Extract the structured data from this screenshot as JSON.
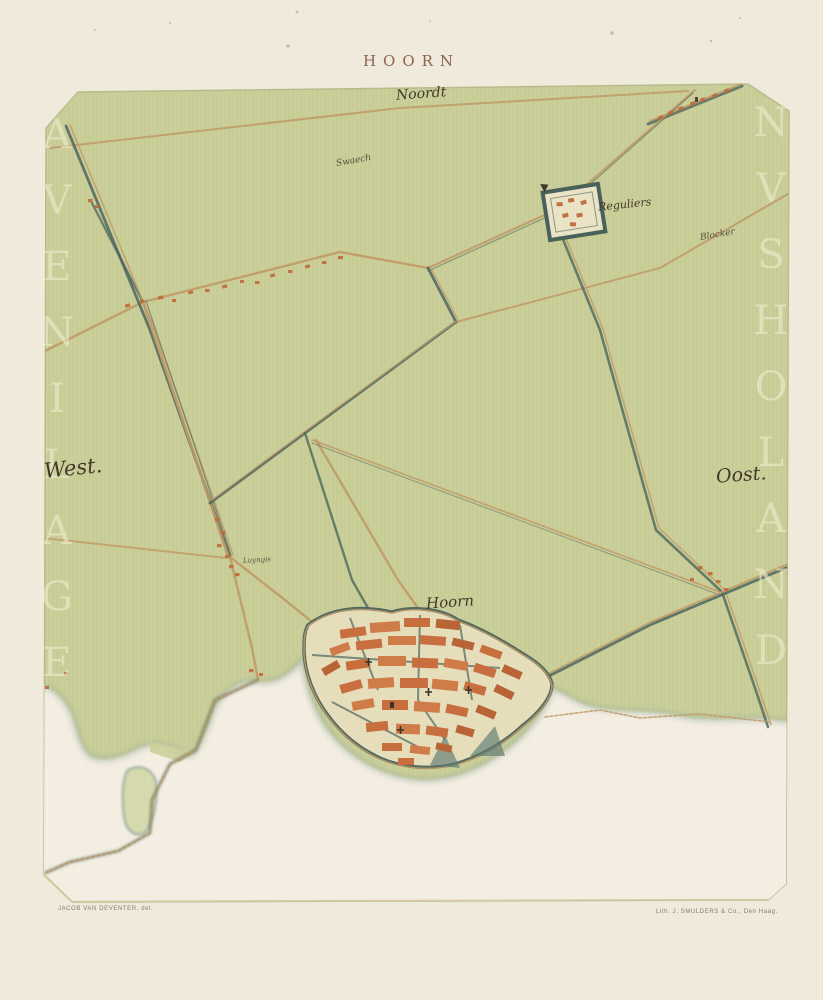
{
  "page": {
    "title": "HOORN",
    "imprint_left": "JACOB VAN DEVENTER, del.",
    "imprint_right": "Lith. J. SMULDERS & Co., Den Haag.",
    "background_color": "#f0ebdc",
    "title_color": "#8c6350"
  },
  "map": {
    "type": "historical-town-plan",
    "town": "Hoorn",
    "sheet_color": "#cbd09a",
    "sea_color": "#f4efe2",
    "labels": {
      "north": "Noordt",
      "west": "West.",
      "east": "Oost.",
      "town": "Hoorn",
      "monastery": "Reguliers",
      "village_north": "Swaech",
      "village_east": "Blocker",
      "hamlet": "Luyngis"
    },
    "ghost_text_left": "AVENILAGE",
    "ghost_text_right": "NVSHOLAND",
    "colors": {
      "road": "#c09a67",
      "canal": "#4c665f",
      "buildings": "#c06b3c",
      "shore_fringe": "#8fa59b",
      "lake": "#d6daad"
    }
  }
}
